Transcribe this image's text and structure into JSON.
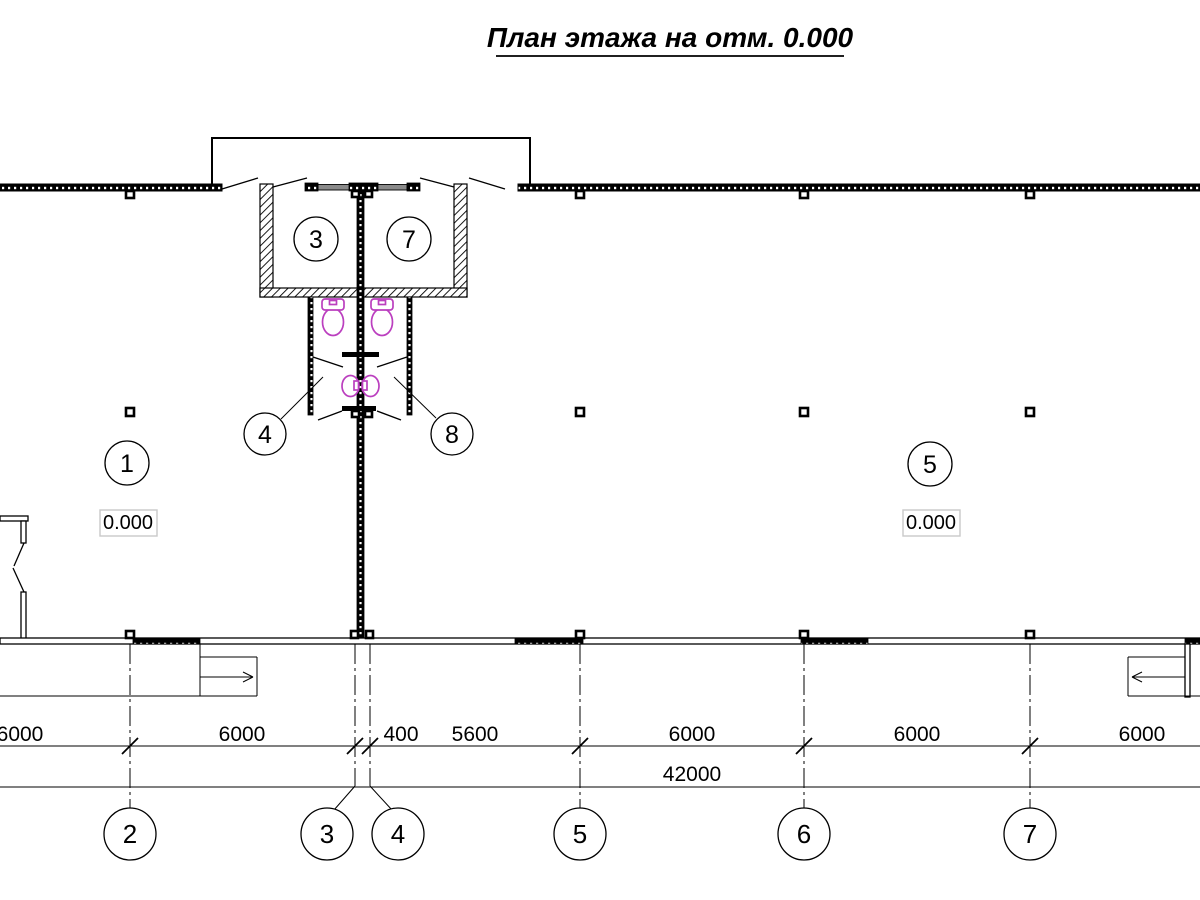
{
  "title": "План этажа на отм. 0.000",
  "drawing": {
    "room_tags": [
      {
        "label": "3"
      },
      {
        "label": "7"
      },
      {
        "label": "4"
      },
      {
        "label": "8"
      },
      {
        "label": "1"
      },
      {
        "label": "5"
      }
    ],
    "elevation_marks": [
      {
        "value": "0.000"
      },
      {
        "value": "0.000"
      }
    ],
    "axes": [
      {
        "label": "2"
      },
      {
        "label": "3"
      },
      {
        "label": "4"
      },
      {
        "label": "5"
      },
      {
        "label": "6"
      },
      {
        "label": "7"
      }
    ],
    "dimensions": {
      "segments": [
        {
          "value": "6000"
        },
        {
          "value": "6000"
        },
        {
          "value": "400"
        },
        {
          "value": "5600"
        },
        {
          "value": "6000"
        },
        {
          "value": "6000"
        },
        {
          "value": "6000"
        }
      ],
      "total": {
        "value": "42000"
      }
    },
    "colors": {
      "line": "#000000",
      "fixture": "#bb3fbf",
      "window_gray": "#8a8a8a",
      "elevation_box_border": "#c9c9c9"
    }
  }
}
